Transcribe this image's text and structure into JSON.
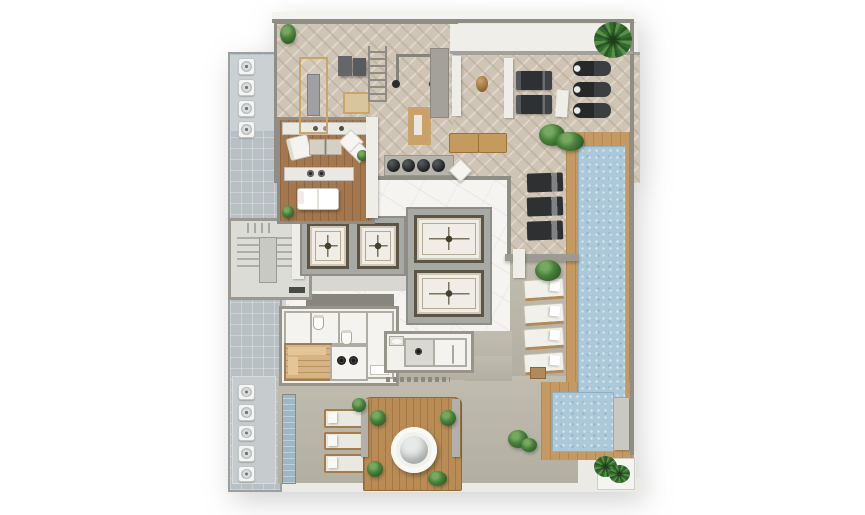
{
  "title_present": false,
  "colors": {
    "wall": "#8f8d84",
    "floor-gym": "#cfc5b6",
    "marble": "#f5f4f1",
    "wood": "#a4784e",
    "wood-sauna": "#d6b383",
    "wood-deck": "#b98c55",
    "pool-deck": "#c59a62",
    "water": "#abc9d9",
    "terrace": "#bcb8aa",
    "strip": "#b9c0c3",
    "stair": "#dcdcd7",
    "white-structure": "#eeede8",
    "walkway": "#ebeae5",
    "gold": "#c9a46b",
    "plant-green": "#3e7135",
    "equipment-dark": "#2e3032"
  },
  "counts": {
    "vent_fans_top": 4,
    "vent_fans_bottom": 5,
    "elevators_left_bank": 2,
    "elevators_center_bank": 2,
    "treadmills": 2,
    "spin_bikes": 3,
    "kettlebells": 4,
    "gym_loungers_dark": 3,
    "pool_loungers_white": 4,
    "terrace_loungers": 3
  }
}
